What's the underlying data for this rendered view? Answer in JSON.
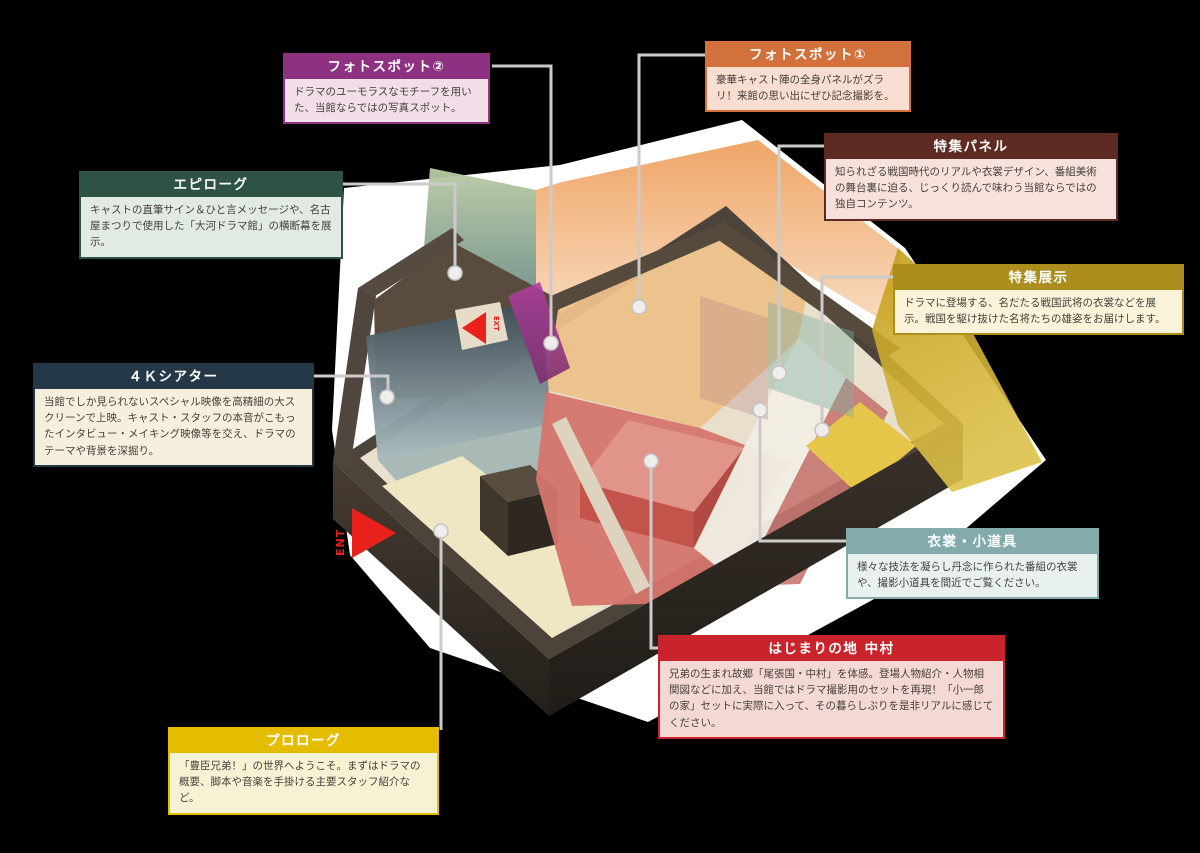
{
  "canvas": {
    "background": "#000000",
    "backdrop_glow": "#ffffff"
  },
  "arrows": {
    "entrance": {
      "label": "ENT",
      "color": "#e8211d"
    },
    "exit": {
      "label": "EXT",
      "color": "#e8211d"
    }
  },
  "leader": {
    "line": "#cccbc9",
    "dot": "#efeeec",
    "dot_stroke": "#c6c5c3"
  },
  "callouts": {
    "photo_spot_2": {
      "title": "フォトスポット②",
      "body": "ドラマのユーモラスなモチーフを用いた、当館ならではの写真スポット。",
      "header_color": "#8e3180",
      "body_bg": "#f1dee9"
    },
    "photo_spot_1": {
      "title": "フォトスポット①",
      "body": "豪華キャスト陣の全身パネルがズラリ！来館の思い出にぜひ記念撮影を。",
      "header_color": "#d2713c",
      "body_bg": "#f8ddd1"
    },
    "feature_panel": {
      "title": "特集パネル",
      "body": "知られざる戦国時代のリアルや衣裳デザイン、番組美術の舞台裏に迫る、じっくり読んで味わう当館ならではの独自コンテンツ。",
      "header_color": "#5e2b22",
      "body_bg": "#f7e1dc"
    },
    "epilogue": {
      "title": "エピローグ",
      "body": "キャストの直筆サイン＆ひと言メッセージや、名古屋まつりで使用した「大河ドラマ館」の横断幕を展示。",
      "header_color": "#2e5244",
      "body_bg": "#e1ebe1"
    },
    "special_exhibition": {
      "title": "特集展示",
      "body": "ドラマに登場する、名だたる戦国武将の衣裳などを展示。戦国を駆け抜けた名将たちの雄姿をお届けします。",
      "header_color": "#ab8e1e",
      "body_bg": "#faf3d9"
    },
    "theater_4k": {
      "title": "４Ｋシアター",
      "body": "当館でしか見られないスペシャル映像を高精細の大スクリーンで上映。キャスト・スタッフの本音がこもったインタビュー・メイキング映像等を交え、ドラマのテーマや背景を深掘り。",
      "header_color": "#253847",
      "body_bg": "#f6efdd"
    },
    "costumes_props": {
      "title": "衣裳・小道具",
      "body": "様々な技法を凝らし丹念に作られた番組の衣裳や、撮影小道具を間近でご覧ください。",
      "header_color": "#84abac",
      "body_bg": "#e9f1ef"
    },
    "nakamura": {
      "title": "はじまりの地 中村",
      "body": "兄弟の生まれ故郷「尾張国・中村」を体感。登場人物紹介・人物相関図などに加え、当館ではドラマ撮影用のセットを再現！「小一郎の家」セットに実際に入って、その暮らしぶりを是非リアルに感じてください。",
      "header_color": "#c9242b",
      "body_bg": "#f4d8d3"
    },
    "prologue": {
      "title": "プロローグ",
      "body": "「豊臣兄弟！」の世界へようこそ。まずはドラマの概要、脚本や音楽を手掛ける主要スタッフ紹介など。",
      "header_color": "#e5bd00",
      "body_bg": "#f6f3d5"
    }
  },
  "floorplan": {
    "zones": {
      "outer_wall": "#4c433a",
      "inner_floor": "#e8dfcd",
      "wall_band": "#4f463d",
      "wall_band_light": "#554b41",
      "epilogue_floor": "#594c3f",
      "wall_strip": "#ddd3bf",
      "back_cap": "#564a3d",
      "theater_floor": "#a9bab6",
      "corridor_floor": "#efe7c4",
      "pillar_top": "#584c3e",
      "pillar_front": "#3f362c",
      "pillar_side": "#2f2821",
      "orange_floor": "#ecc089",
      "red_floor": "#d5756d",
      "red_box_top": "#e0948a",
      "red_box_front": "#c2544c",
      "red_box_side": "#b04a43",
      "white_path": "#f1ede3",
      "red_carpet": "#c57770",
      "yellow_floor": "#e6c648",
      "teal_panel": "#7fae9f",
      "mauve_panel": "#b98a8a",
      "ext_patch": "#e6dcc8"
    },
    "gradients": {
      "green_wall_top": "#b9caa4",
      "green_wall_bottom": "#70908a",
      "orange_wall_top": "#efa261",
      "orange_wall_bottom": "#f8dcc0",
      "gold_wall_top": "#c39d1a",
      "gold_wall_bottom": "#ddc14a",
      "blue_wall_top": "#3d4a52",
      "blue_wall_bottom": "#a7bcc0",
      "purple_wall_top": "#b13f9e",
      "purple_wall_bottom": "#7c2a6e",
      "front_wall_left_top": "#463c33",
      "front_wall_left_bottom": "#241f1a",
      "front_wall_right_top": "#3a312a",
      "front_wall_right_bottom": "#201c17"
    }
  }
}
